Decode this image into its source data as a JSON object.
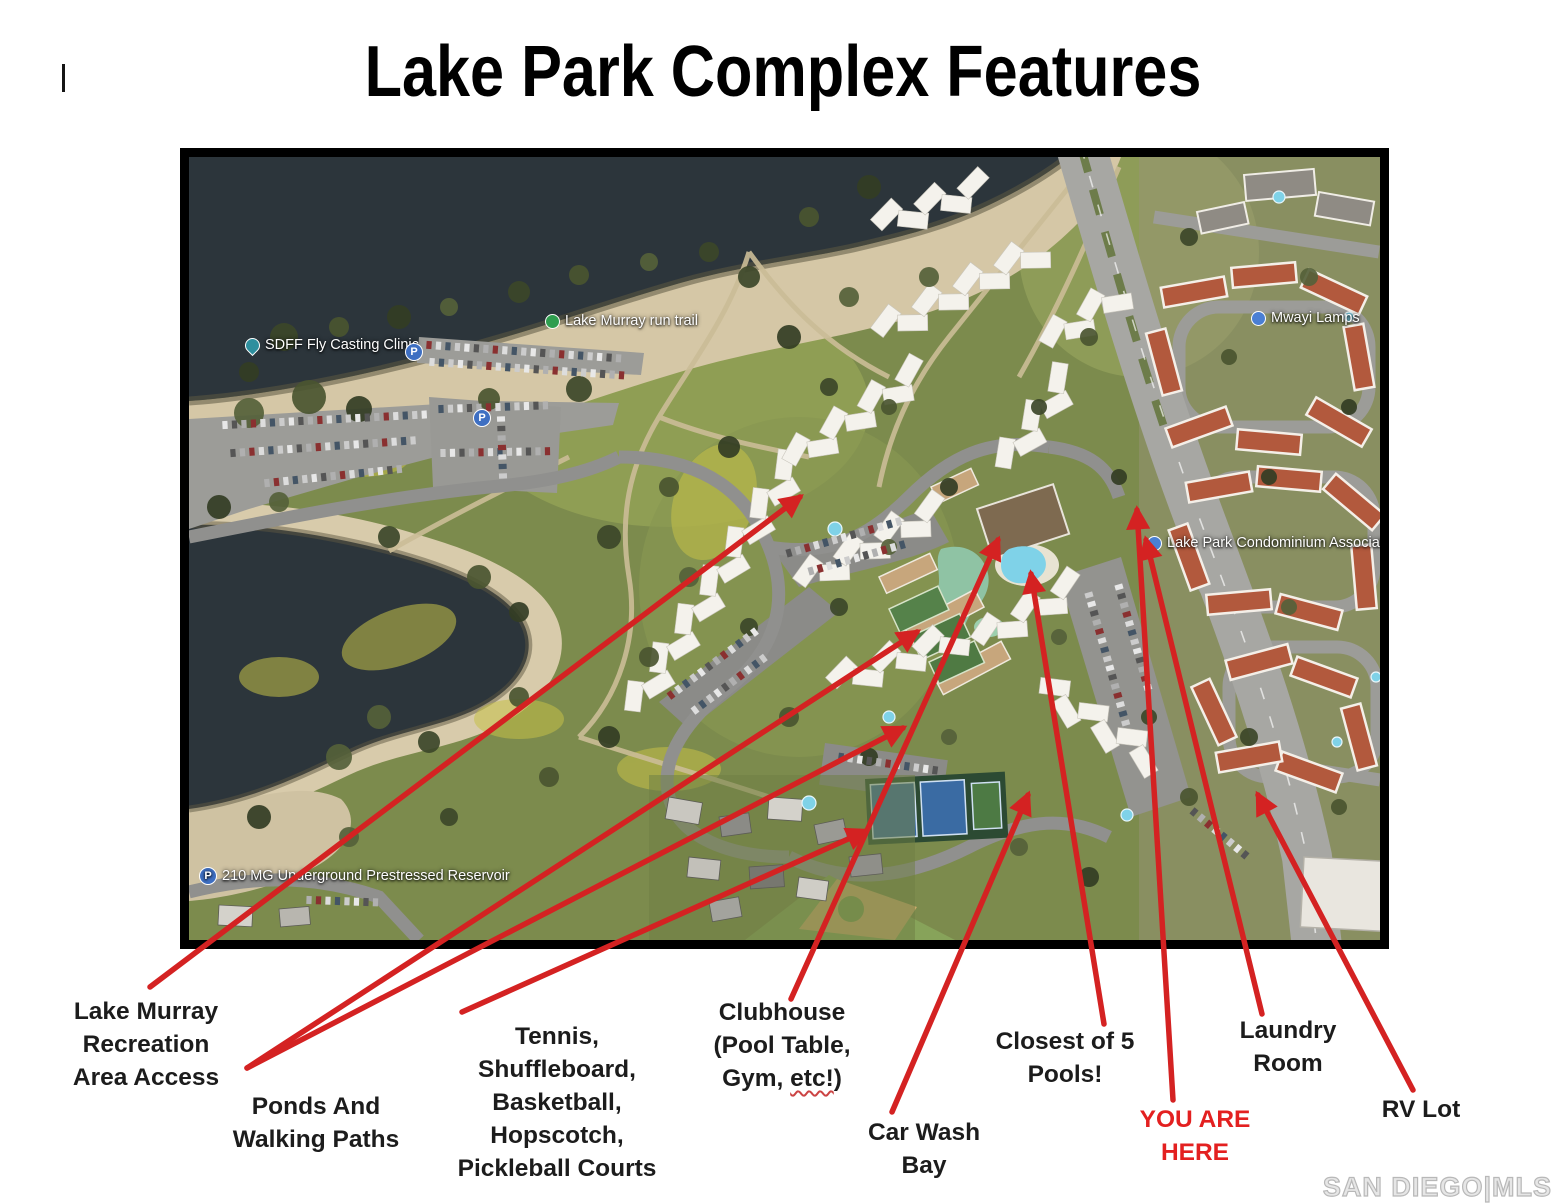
{
  "title": "Lake Park Complex Features",
  "watermark": "SAN DIEGO|MLS",
  "map_poi": {
    "fly_casting": "SDFF Fly Casting Clinic",
    "run_trail": "Lake Murray run trail",
    "mwayi_lamps": "Mwayi Lamps",
    "condo_assoc": "Lake Park Condominium Associates",
    "reservoir": "210 MG Underground Prestressed Reservoir",
    "parking_icon": "P"
  },
  "colors": {
    "arrow": "#d42222",
    "label_text": "#1c1c1c",
    "you_are_here": "#e32020",
    "map_border": "#000000"
  },
  "annotations": [
    {
      "id": "lake-murray-access",
      "lines": [
        "Lake Murray",
        "Recreation",
        "Area Access"
      ],
      "arrows": [
        [
          150,
          987,
          800,
          497
        ]
      ]
    },
    {
      "id": "ponds-walking-paths",
      "lines": [
        "Ponds And",
        "Walking Paths"
      ],
      "arrows": [
        [
          247,
          1068,
          917,
          632
        ],
        [
          247,
          1068,
          903,
          728
        ]
      ]
    },
    {
      "id": "tennis-courts",
      "lines": [
        "Tennis,",
        "Shuffleboard,",
        "Basketball,",
        "Hopscotch,",
        "Pickleball Courts"
      ],
      "arrows": [
        [
          462,
          1012,
          866,
          831
        ]
      ]
    },
    {
      "id": "clubhouse",
      "lines": [
        "Clubhouse",
        "(Pool Table,"
      ],
      "line3": {
        "pre": "Gym, ",
        "wavy": "etc!",
        "post": ")"
      },
      "arrows": [
        [
          791,
          999,
          998,
          540
        ]
      ]
    },
    {
      "id": "car-wash-bay",
      "lines": [
        "Car Wash",
        "Bay"
      ],
      "arrows": [
        [
          892,
          1112,
          1028,
          795
        ]
      ]
    },
    {
      "id": "closest-pools",
      "lines": [
        "Closest of 5",
        "Pools!"
      ],
      "arrows": [
        [
          1104,
          1024,
          1031,
          574
        ]
      ]
    },
    {
      "id": "you-are-here",
      "lines": [
        "YOU ARE",
        "HERE"
      ],
      "color": "#e32020",
      "arrows": [
        [
          1173,
          1100,
          1137,
          510
        ]
      ]
    },
    {
      "id": "laundry-room",
      "lines": [
        "Laundry",
        "Room"
      ],
      "arrows": [
        [
          1262,
          1014,
          1146,
          540
        ]
      ]
    },
    {
      "id": "rv-lot",
      "lines": [
        "RV Lot"
      ],
      "arrows": [
        [
          1413,
          1090,
          1258,
          795
        ]
      ]
    }
  ]
}
